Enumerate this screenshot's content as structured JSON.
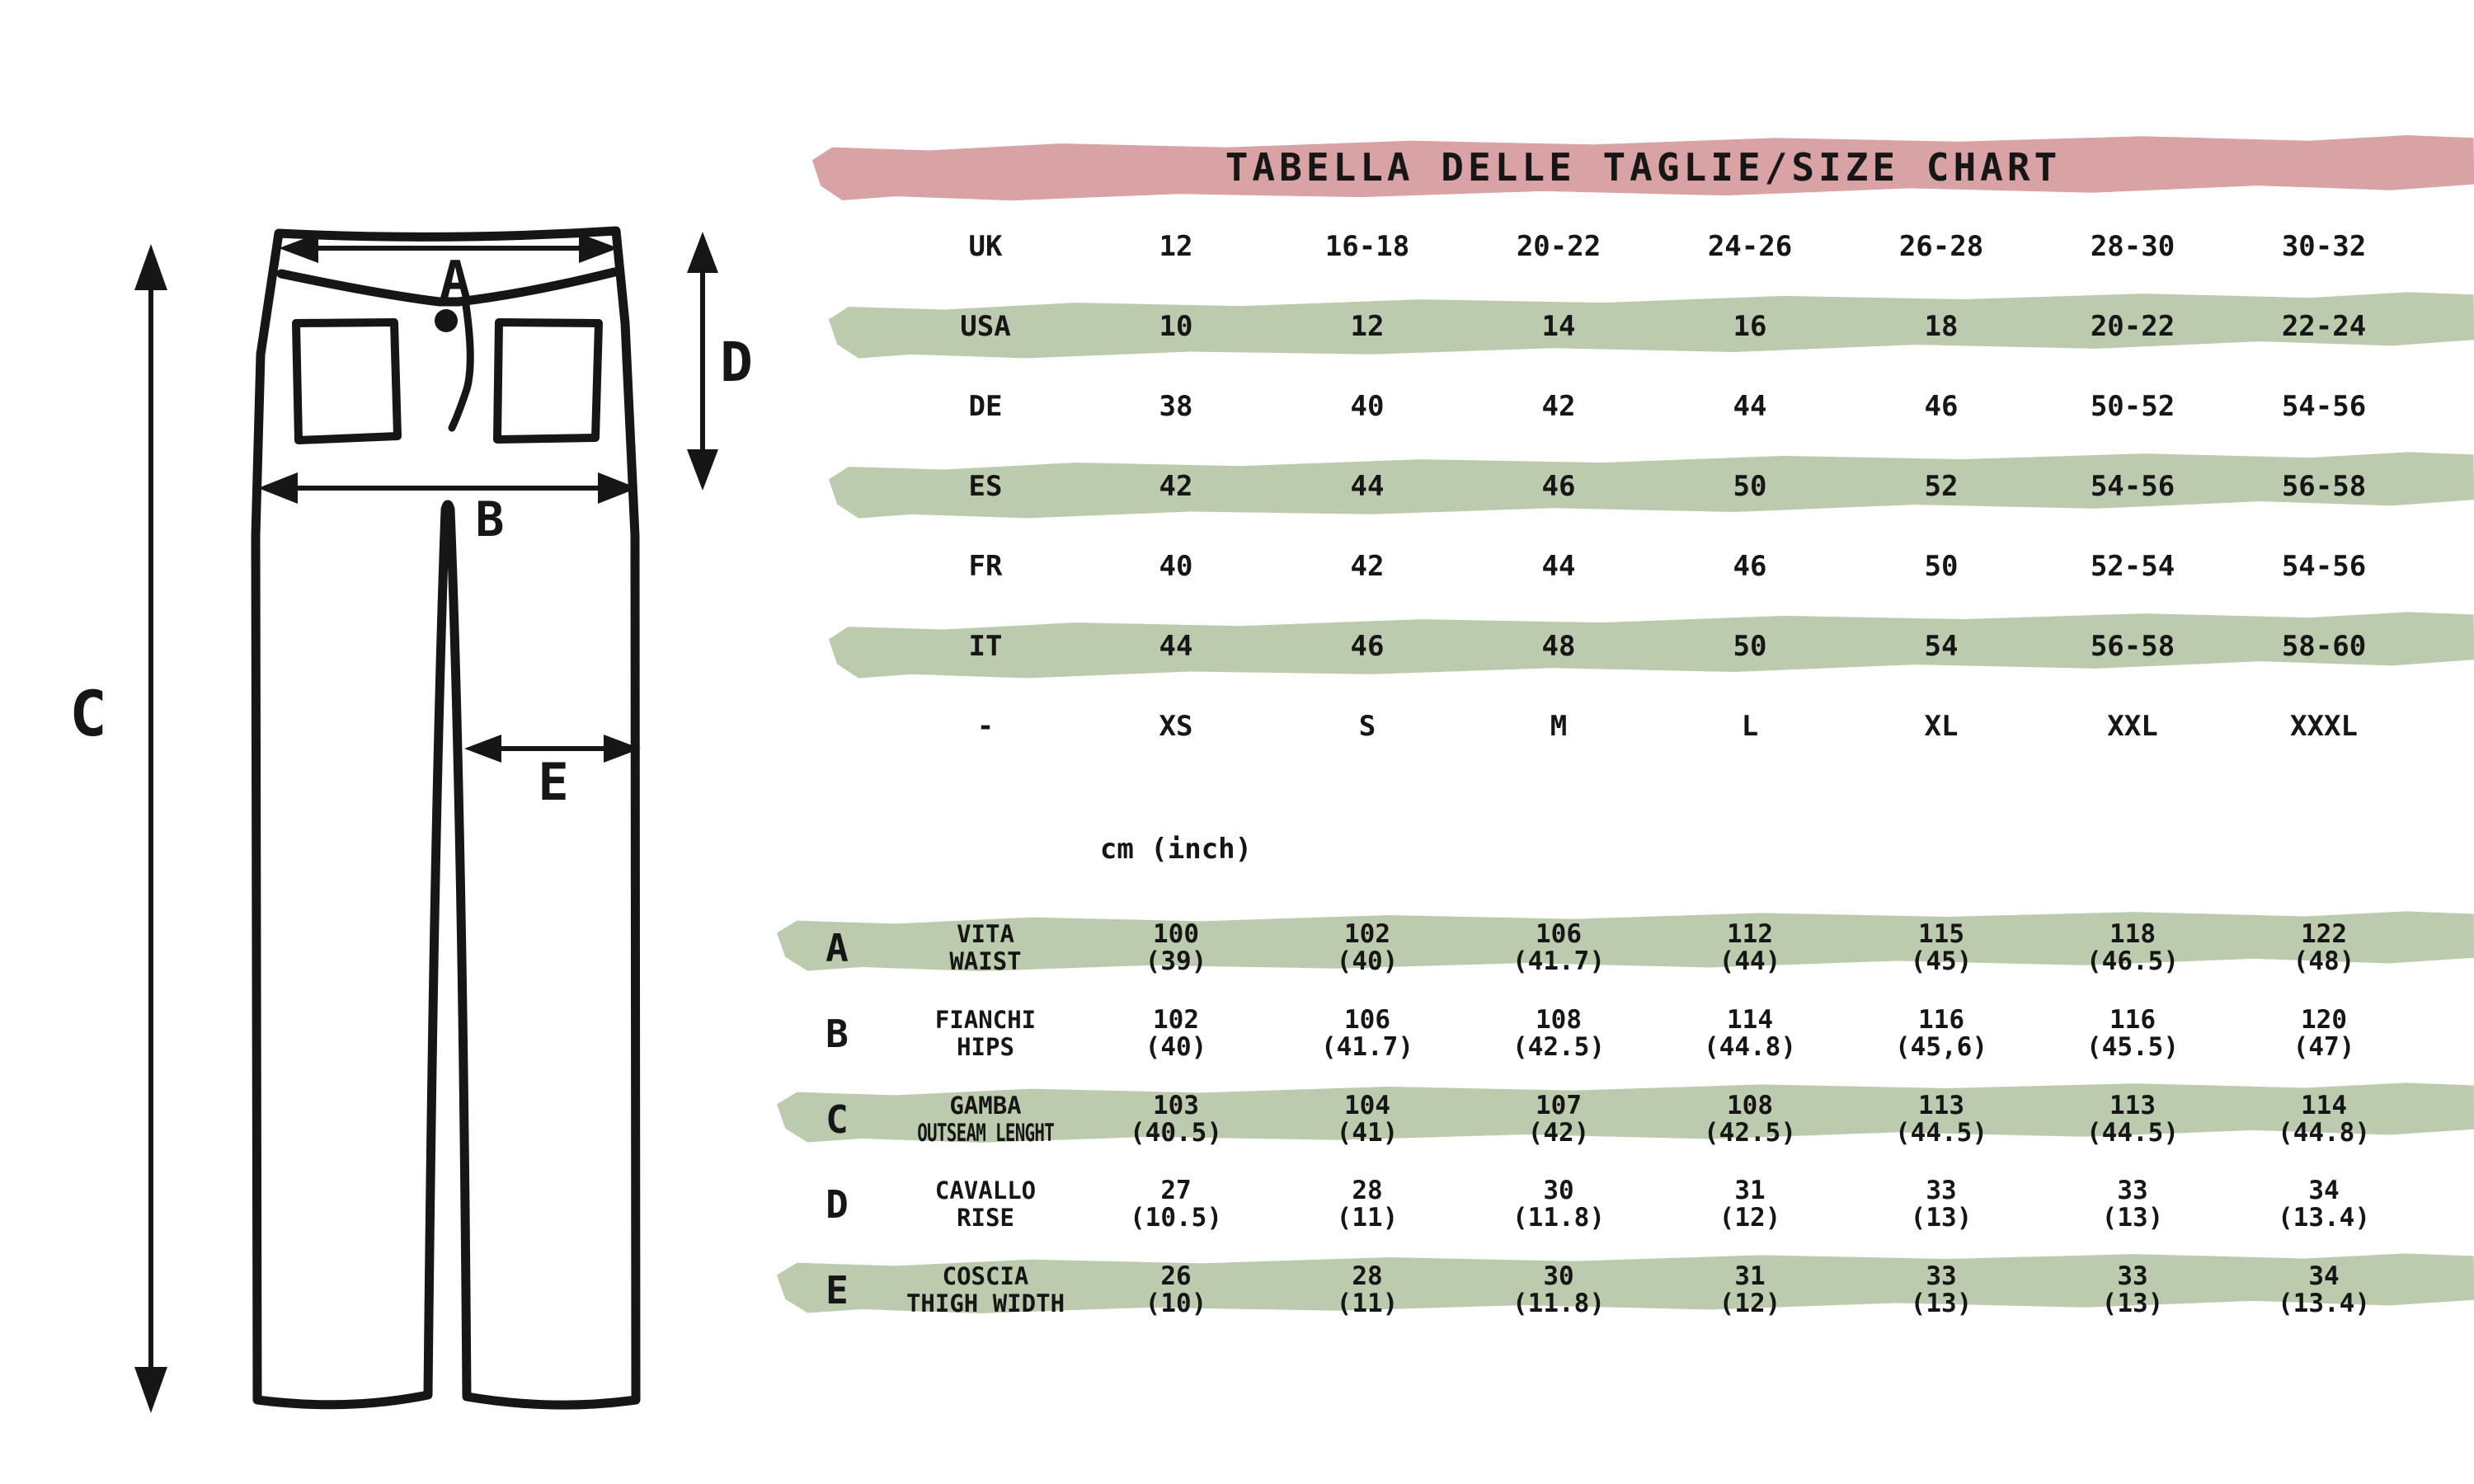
{
  "title": "TABELLA DELLE TAGLIE/SIZE CHART",
  "unit_label": "cm (inch)",
  "colors": {
    "pink": "#d9a2a4",
    "green": "#bccbad",
    "ink": "#161616"
  },
  "diagram": {
    "description": "pants line drawing with measurement arrows",
    "measure_labels": {
      "a": "A",
      "b": "B",
      "c": "C",
      "d": "D",
      "e": "E"
    }
  },
  "size_table": {
    "rows": [
      {
        "region": "UK",
        "highlight": false,
        "values": [
          "12",
          "16-18",
          "20-22",
          "24-26",
          "26-28",
          "28-30",
          "30-32"
        ]
      },
      {
        "region": "USA",
        "highlight": true,
        "values": [
          "10",
          "12",
          "14",
          "16",
          "18",
          "20-22",
          "22-24"
        ]
      },
      {
        "region": "DE",
        "highlight": false,
        "values": [
          "38",
          "40",
          "42",
          "44",
          "46",
          "50-52",
          "54-56"
        ]
      },
      {
        "region": "ES",
        "highlight": true,
        "values": [
          "42",
          "44",
          "46",
          "50",
          "52",
          "54-56",
          "56-58"
        ]
      },
      {
        "region": "FR",
        "highlight": false,
        "values": [
          "40",
          "42",
          "44",
          "46",
          "50",
          "52-54",
          "54-56"
        ]
      },
      {
        "region": "IT",
        "highlight": true,
        "values": [
          "44",
          "46",
          "48",
          "50",
          "54",
          "56-58",
          "58-60"
        ]
      },
      {
        "region": "-",
        "highlight": false,
        "values": [
          "XS",
          "S",
          "M",
          "L",
          "XL",
          "XXL",
          "XXXL"
        ]
      }
    ]
  },
  "measurement_table": {
    "rows": [
      {
        "letter": "A",
        "name_it": "VITA",
        "name_en": "WAIST",
        "highlight": true,
        "cm": [
          "100",
          "102",
          "106",
          "112",
          "115",
          "118",
          "122"
        ],
        "inch": [
          "(39)",
          "(40)",
          "(41.7)",
          "(44)",
          "(45)",
          "(46.5)",
          "(48)"
        ]
      },
      {
        "letter": "B",
        "name_it": "FIANCHI",
        "name_en": "HIPS",
        "highlight": false,
        "cm": [
          "102",
          "106",
          "108",
          "114",
          "116",
          "116",
          "120"
        ],
        "inch": [
          "(40)",
          "(41.7)",
          "(42.5)",
          "(44.8)",
          "(45,6)",
          "(45.5)",
          "(47)"
        ]
      },
      {
        "letter": "C",
        "name_it": "GAMBA",
        "name_en": "OUTSEAM LENGHT",
        "highlight": true,
        "cm": [
          "103",
          "104",
          "107",
          "108",
          "113",
          "113",
          "114"
        ],
        "inch": [
          "(40.5)",
          "(41)",
          "(42)",
          "(42.5)",
          "(44.5)",
          "(44.5)",
          "(44.8)"
        ]
      },
      {
        "letter": "D",
        "name_it": "CAVALLO",
        "name_en": "RISE",
        "highlight": false,
        "cm": [
          "27",
          "28",
          "30",
          "31",
          "33",
          "33",
          "34"
        ],
        "inch": [
          "(10.5)",
          "(11)",
          "(11.8)",
          "(12)",
          "(13)",
          "(13)",
          "(13.4)"
        ]
      },
      {
        "letter": "E",
        "name_it": "COSCIA",
        "name_en": "THIGH WIDTH",
        "highlight": true,
        "cm": [
          "26",
          "28",
          "30",
          "31",
          "33",
          "33",
          "34"
        ],
        "inch": [
          "(10)",
          "(11)",
          "(11.8)",
          "(12)",
          "(13)",
          "(13)",
          "(13.4)"
        ]
      }
    ]
  }
}
